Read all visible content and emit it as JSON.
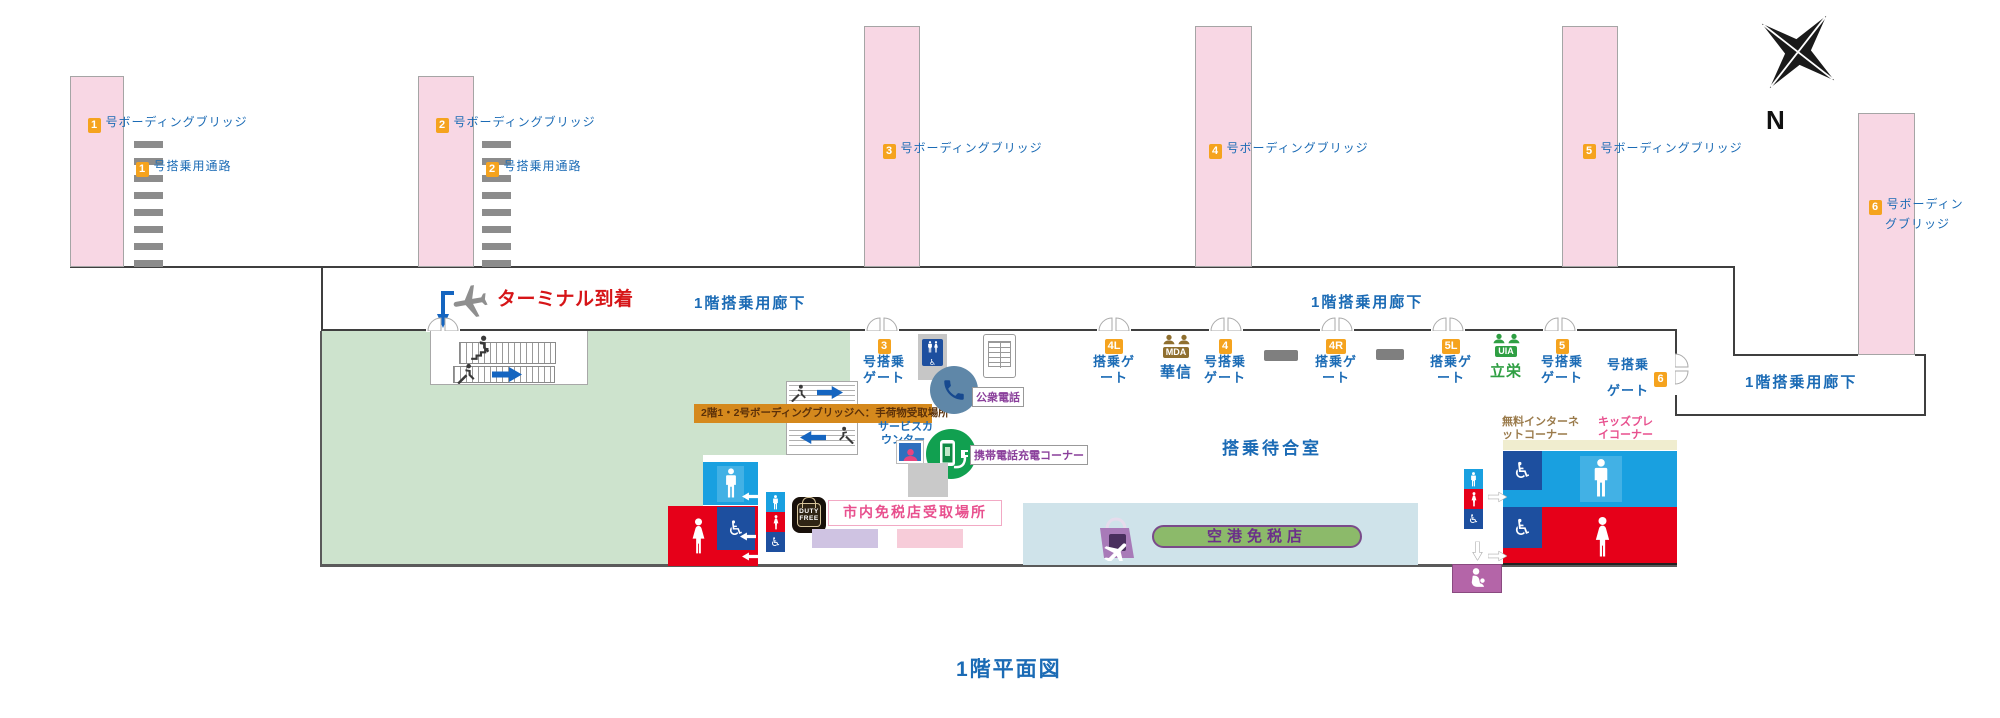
{
  "title": "1階平面図",
  "compass_label": "N",
  "colors": {
    "accent-blue": "#1b6bb5",
    "gate-orange": "#f5a31e",
    "arrival-red": "#d61518",
    "bridge-pink": "#f8d7e4",
    "green-area": "#cde3cd",
    "banner-orange": "#d5891d",
    "men-blue": "#19a0e0",
    "women-red": "#e60019",
    "access-blue": "#1d4f9f",
    "nursing-purple": "#b465a8",
    "shop-blue": "#cfe3ea",
    "dutyfree-green": "#8cba6a",
    "purple": "#8a3f9b",
    "pink-text": "#e8508e",
    "brown-text": "#9a7a4a",
    "mda-brown": "#8f6f2f",
    "uia-green": "#2f9f43",
    "phone-circle": "#5f87a8",
    "charge-green": "#11a050",
    "arrow-blue": "#1565c0"
  },
  "icons": {
    "wheelchair": "♿"
  },
  "bridges": [
    {
      "num": "1",
      "label": "号ボーディングブリッジ"
    },
    {
      "num": "2",
      "label": "号ボーディングブリッジ"
    },
    {
      "num": "3",
      "label": "号ボーディングブリッジ"
    },
    {
      "num": "4",
      "label": "号ボーディングブリッジ"
    },
    {
      "num": "5",
      "label": "号ボーディングブリッジ"
    },
    {
      "num": "6",
      "label": "号ボーディン",
      "label2": "グブリッジ"
    }
  ],
  "walkways": [
    {
      "num": "1",
      "label": "号搭乗用通路"
    },
    {
      "num": "2",
      "label": "号搭乗用通路"
    }
  ],
  "corridor": {
    "arrival_label": "ターミナル到着",
    "hall_label_1": "1階搭乗用廊下",
    "hall_label_2": "1階搭乗用廊下",
    "hall_label_right": "1階搭乗用廊下"
  },
  "gates": [
    {
      "num": "3",
      "line1": "号搭乗",
      "line2": "ゲート"
    },
    {
      "num": "4L",
      "line1": "搭乗ゲ",
      "line2": "ート"
    },
    {
      "num": "4",
      "line1": "号搭乗",
      "line2": "ゲート"
    },
    {
      "num": "4R",
      "line1": "搭乗ゲ",
      "line2": "ート"
    },
    {
      "num": "5L",
      "line1": "搭乗ゲ",
      "line2": "ート"
    },
    {
      "num": "5",
      "line1": "号搭乗",
      "line2": "ゲート"
    },
    {
      "num": "6",
      "line1": "号搭乗",
      "line2": "ゲート"
    }
  ],
  "airlines": [
    {
      "code": "MDA",
      "name": "華信"
    },
    {
      "code": "UIA",
      "name": "立栄"
    }
  ],
  "labels": {
    "waiting_room": "搭乗待合室",
    "public_phone": "公衆電話",
    "charging_corner": "携帯電話充電コーナー",
    "service_counter_line1": "サービスカ",
    "service_counter_line2": "ウンター",
    "city_dutyfree_pickup": "市内免税店受取場所",
    "airport_dutyfree": "空港免税店",
    "internet_line1": "無料インターネ",
    "internet_line2": "ットコーナー",
    "kids_line1": "キッズプレ",
    "kids_line2": "イコーナー",
    "banner_2f": "2階1・2号ボーディングブリッジへ：手荷物受取場所",
    "dutyfree_line1": "DUTY",
    "dutyfree_line2": "FREE"
  }
}
